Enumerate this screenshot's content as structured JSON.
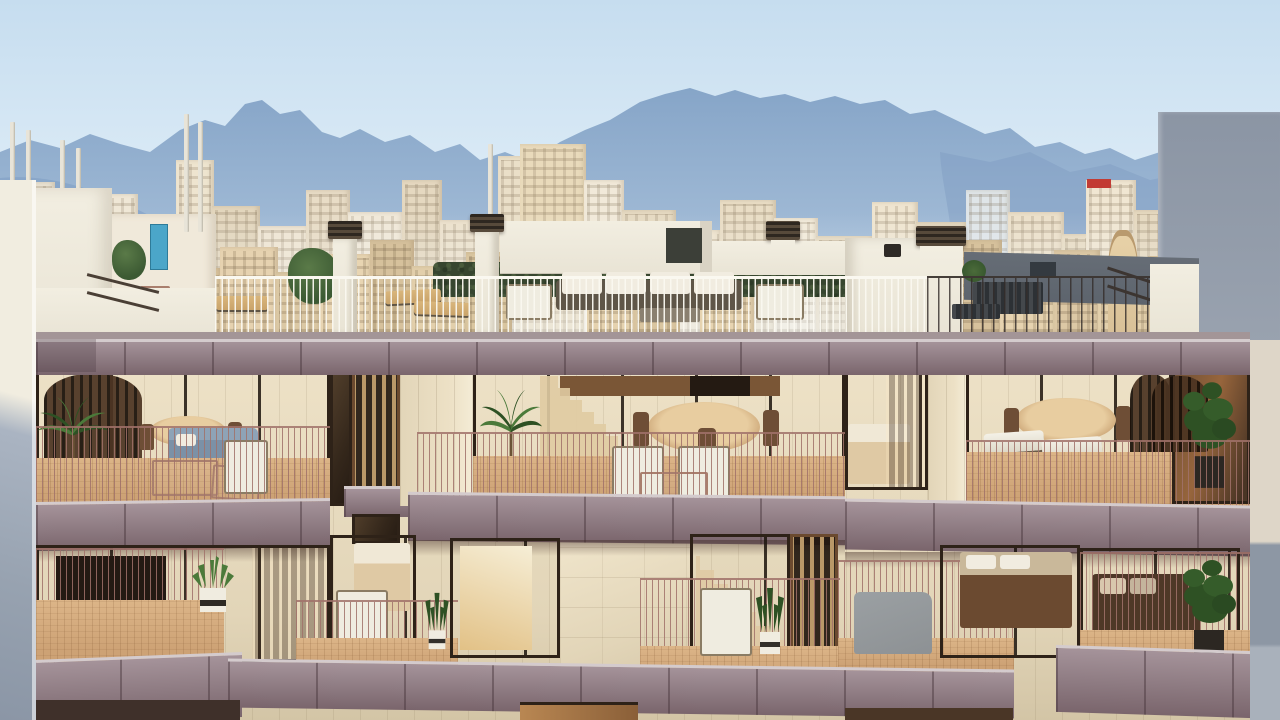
{
  "meta": {
    "description": "Sunset architectural rendering of a modern cream-stone apartment building with mauve balcony fascias, rose metal railings, glazed apartments with warm lit interiors, roof terrace with hedge and outdoor furniture, set against a Mediterranean city skyline and hazy blue mountains under a pale sky.",
    "scene_type": "architectural-render",
    "time_of_day": "golden hour",
    "location_style": "Palma de Mallorca style cityscape"
  },
  "palette": {
    "sky_top": "#c6ddef",
    "sky_mid": "#ddecf7",
    "sky_horizon": "#eef5fa",
    "mountain_far_top": "#86a5c8",
    "mountain_far_bottom": "#c2d4e5",
    "mountain_near": "#7e9cc2",
    "white_wall": "#f2eee1",
    "gray_wall": "#8b95a4",
    "gray_wall_light": "#99a2af",
    "fascia_light": "#a5939a",
    "fascia_mid": "#8d7a81",
    "fascia_dark": "#7a656c",
    "fascia_lip": "#d4cbcd",
    "facade_light": "#ede1c6",
    "facade_mid": "#e2d5b8",
    "facade_dark": "#d3c5a6",
    "deck": "#cda275",
    "deck_light": "#dcb588",
    "railing": "#a1726a",
    "frame": "#2e2218",
    "glass_warm": "#97653c",
    "interior_warm": "#d8a96b",
    "interior_glow": "#f0cf95",
    "wood_slat": "#b99868",
    "hedge": "#37462f",
    "slate_wall": "#5d646d",
    "plant_green": "#4b7a3a",
    "plant_dark": "#2e5124",
    "blue_sofa": "#7b91a7",
    "white_furn": "#efece0",
    "tan_lounge": "#c9a36a",
    "gray_furn": "#8d9194",
    "bed_sheet": "#dfc9a4",
    "mast": "#e8e4d8",
    "tree": "#3c5a33",
    "tree_light": "#5a7a48",
    "teal_door": "#4ba6c9",
    "red_sign": "#c23b34"
  },
  "city": {
    "baseline_y": 332,
    "back_buildings": [
      {
        "x": 0,
        "w": 55,
        "h": 150,
        "c": "#e9e2d2"
      },
      {
        "x": 50,
        "w": 40,
        "h": 120,
        "c": "#e2d8c4"
      },
      {
        "x": 88,
        "w": 50,
        "h": 138,
        "c": "#efe7d6"
      },
      {
        "x": 135,
        "w": 45,
        "h": 112,
        "c": "#e6d9bf"
      },
      {
        "x": 176,
        "w": 38,
        "h": 172,
        "c": "#eee4cf"
      },
      {
        "x": 212,
        "w": 48,
        "h": 126,
        "c": "#e3d6bd"
      },
      {
        "x": 258,
        "w": 52,
        "h": 106,
        "c": "#efe5d2"
      },
      {
        "x": 306,
        "w": 44,
        "h": 142,
        "c": "#e8dcc6"
      },
      {
        "x": 348,
        "w": 56,
        "h": 120,
        "c": "#f0e8d8"
      },
      {
        "x": 402,
        "w": 40,
        "h": 152,
        "c": "#e5d8c0"
      },
      {
        "x": 440,
        "w": 60,
        "h": 112,
        "c": "#ece1cc"
      },
      {
        "x": 498,
        "w": 46,
        "h": 176,
        "c": "#eadfc8"
      },
      {
        "x": 520,
        "w": 66,
        "h": 188,
        "c": "#e9dabb"
      },
      {
        "x": 584,
        "w": 40,
        "h": 152,
        "c": "#f1e9d9"
      },
      {
        "x": 622,
        "w": 54,
        "h": 122,
        "c": "#e6dac2"
      },
      {
        "x": 674,
        "w": 48,
        "h": 102,
        "c": "#eee3cd"
      },
      {
        "x": 720,
        "w": 56,
        "h": 132,
        "c": "#e9ddc5"
      },
      {
        "x": 774,
        "w": 44,
        "h": 114,
        "c": "#f2ead9"
      },
      {
        "x": 816,
        "w": 58,
        "h": 96,
        "c": "#e7dbc3"
      },
      {
        "x": 872,
        "w": 46,
        "h": 130,
        "c": "#efe5d0"
      },
      {
        "x": 916,
        "w": 52,
        "h": 110,
        "c": "#e4d7bd"
      },
      {
        "x": 966,
        "w": 44,
        "h": 142,
        "c": "#dfe5e8"
      },
      {
        "x": 1008,
        "w": 56,
        "h": 120,
        "c": "#ece0ca"
      },
      {
        "x": 1062,
        "w": 48,
        "h": 98,
        "c": "#e8dcc4"
      },
      {
        "x": 1086,
        "w": 50,
        "h": 152,
        "c": "#f0e6d2"
      },
      {
        "x": 1134,
        "w": 46,
        "h": 122,
        "c": "#e6d9c0"
      },
      {
        "x": 1178,
        "w": 60,
        "h": 102,
        "c": "#ede2cc"
      },
      {
        "x": 1236,
        "w": 44,
        "h": 132,
        "c": "#e3d6bc"
      }
    ],
    "front_buildings": [
      {
        "x": 0,
        "w": 42,
        "h": 88,
        "c": "#dcc9a6"
      },
      {
        "x": 40,
        "w": 50,
        "h": 70,
        "c": "#e7d3ae"
      },
      {
        "x": 88,
        "w": 40,
        "h": 95,
        "c": "#d9c5a2"
      },
      {
        "x": 126,
        "w": 54,
        "h": 75,
        "c": "#e3cfa9"
      },
      {
        "x": 178,
        "w": 44,
        "h": 64,
        "c": "#d8c29c"
      },
      {
        "x": 220,
        "w": 58,
        "h": 85,
        "c": "#e6d2b0"
      },
      {
        "x": 276,
        "w": 46,
        "h": 60,
        "c": "#dbc8a4"
      },
      {
        "x": 320,
        "w": 52,
        "h": 78,
        "c": "#e8d5b2"
      },
      {
        "x": 370,
        "w": 44,
        "h": 92,
        "c": "#d6c19c"
      },
      {
        "x": 412,
        "w": 56,
        "h": 66,
        "c": "#e2cfab"
      },
      {
        "x": 466,
        "w": 46,
        "h": 80,
        "c": "#dac6a0"
      },
      {
        "x": 586,
        "w": 50,
        "h": 72,
        "c": "#e5d2af"
      },
      {
        "x": 634,
        "w": 46,
        "h": 88,
        "c": "#d9c5a0"
      },
      {
        "x": 700,
        "w": 54,
        "h": 62,
        "c": "#e7d4b1"
      },
      {
        "x": 860,
        "w": 48,
        "h": 84,
        "c": "#dbc7a3"
      },
      {
        "x": 906,
        "w": 54,
        "h": 70,
        "c": "#e4d1ad"
      },
      {
        "x": 958,
        "w": 44,
        "h": 92,
        "c": "#d7c29d"
      },
      {
        "x": 1000,
        "w": 56,
        "h": 64,
        "c": "#e6d3b0"
      },
      {
        "x": 1054,
        "w": 46,
        "h": 82,
        "c": "#dcc8a5"
      },
      {
        "x": 1098,
        "w": 52,
        "h": 60,
        "c": "#e3d0ac"
      },
      {
        "x": 1148,
        "w": 40,
        "h": 76,
        "c": "#d8c4a0"
      }
    ],
    "rooftop_structure": {
      "x": 112,
      "w": 104,
      "h": 118,
      "c": "#f0e9da",
      "door_x": 150,
      "door_y": 224,
      "door_w": 16,
      "door_h": 44
    },
    "church_tower": {
      "x": 1108,
      "w": 30,
      "h": 102,
      "c": "#d9c198"
    },
    "red_sign": {
      "x": 1087,
      "y": 179,
      "w": 24,
      "h": 9
    },
    "masts": [
      {
        "x": 10,
        "y": 122,
        "h": 112
      },
      {
        "x": 26,
        "y": 130,
        "h": 106
      },
      {
        "x": 60,
        "y": 140,
        "h": 92
      },
      {
        "x": 76,
        "y": 148,
        "h": 85
      },
      {
        "x": 184,
        "y": 114,
        "h": 118
      },
      {
        "x": 198,
        "y": 122,
        "h": 110
      },
      {
        "x": 488,
        "y": 144,
        "h": 88
      }
    ],
    "trees": [
      {
        "x": 112,
        "y": 240,
        "w": 34,
        "h": 40
      },
      {
        "x": 288,
        "y": 248,
        "w": 52,
        "h": 56
      },
      {
        "x": 508,
        "y": 234,
        "w": 36,
        "h": 30
      }
    ]
  },
  "hero_building": {
    "storeys_visible": 2,
    "roof": {
      "chimneys_x": [
        330,
        472,
        766
      ],
      "has_hedge": true,
      "furniture": [
        "white outdoor sofa set",
        "tan sun loungers",
        "wire chairs",
        "dark metal bench"
      ]
    },
    "plants": [
      "palm in pot",
      "palm in pot",
      "succulent in striped pot",
      "snake plant",
      "monstera in slatted planter",
      "terrace bush"
    ],
    "furniture": [
      "blue sofa",
      "round dining tables",
      "white sling chairs",
      "white loungers",
      "gray recliner",
      "beds"
    ]
  }
}
